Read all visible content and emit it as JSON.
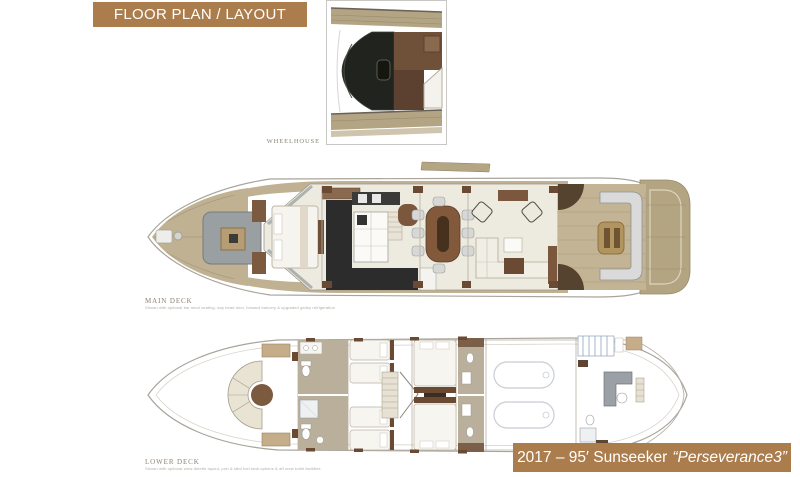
{
  "title_banner": {
    "label": "FLOOR PLAN / LAYOUT",
    "bg": "#ab7d4c",
    "text_color": "#ffffff"
  },
  "decks": {
    "wheelhouse": {
      "label": "WHEELHOUSE"
    },
    "main": {
      "label": "MAIN DECK",
      "fine_print": "Shown with optional bar stool seating, day head door, forward balcony & upgraded galley refrigeration"
    },
    "lower": {
      "label": "LOWER DECK",
      "fine_print": "Shown with optional crew dinette layout, port & stbd fuel tank options & aft crew toilet facilities"
    }
  },
  "caption_banner": {
    "year_model": "2017 – 95′ Sunseeker",
    "boat_name": "“Perseverance3”",
    "bg": "#ab7d4c",
    "text_color": "#ffffff"
  },
  "colors": {
    "banner_brown": "#ab7d4c",
    "teak": "#bfb192",
    "teak_dark": "#b3a482",
    "label_gray": "#8b8478",
    "fine_print_gray": "#b3ada1",
    "hull_outline": "#a8a49b",
    "floor_cream": "#edeadf",
    "furniture_brown": "#7b573d",
    "furniture_dark_brown": "#6b4a33",
    "galley_charcoal": "#2b2c2b",
    "taupe_floor": "#b9af9b",
    "sofa_gray": "#d8d9d8",
    "console_black": "#20231e",
    "crew_stripe_blue": "#8fa3bc"
  }
}
